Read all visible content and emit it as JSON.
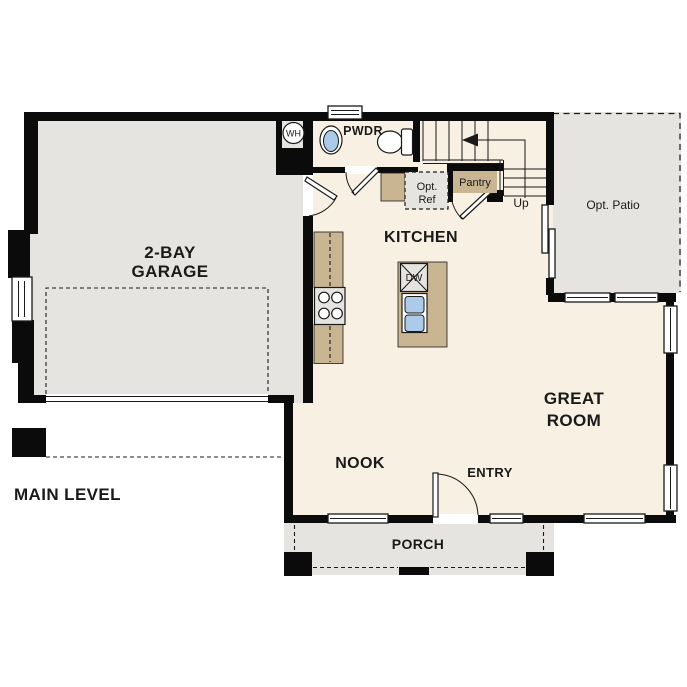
{
  "plan": {
    "title": "MAIN LEVEL"
  },
  "rooms": {
    "garage": {
      "line1": "2-BAY",
      "line2": "GARAGE"
    },
    "kitchen": {
      "label": "KITCHEN"
    },
    "great_room": {
      "line1": "GREAT",
      "line2": "ROOM"
    },
    "nook": {
      "label": "NOOK"
    },
    "entry": {
      "label": "ENTRY"
    },
    "porch": {
      "label": "PORCH"
    },
    "powder": {
      "label": "PWDR"
    },
    "patio": {
      "label": "Opt. Patio"
    },
    "pantry": {
      "label": "Pantry"
    },
    "opt_ref": {
      "line1": "Opt.",
      "line2": "Ref"
    }
  },
  "stairs": {
    "direction_label": "Up"
  },
  "fixtures": {
    "water_heater_label": "WH",
    "dishwasher_label": "DW"
  },
  "colors": {
    "floor": "#F7F0E3",
    "exterior": "#E5E4E0",
    "counter": "#C9B592",
    "sink": "#ABCBE9",
    "wall": "#0B0B0B",
    "ink": "#1A1A1A"
  }
}
